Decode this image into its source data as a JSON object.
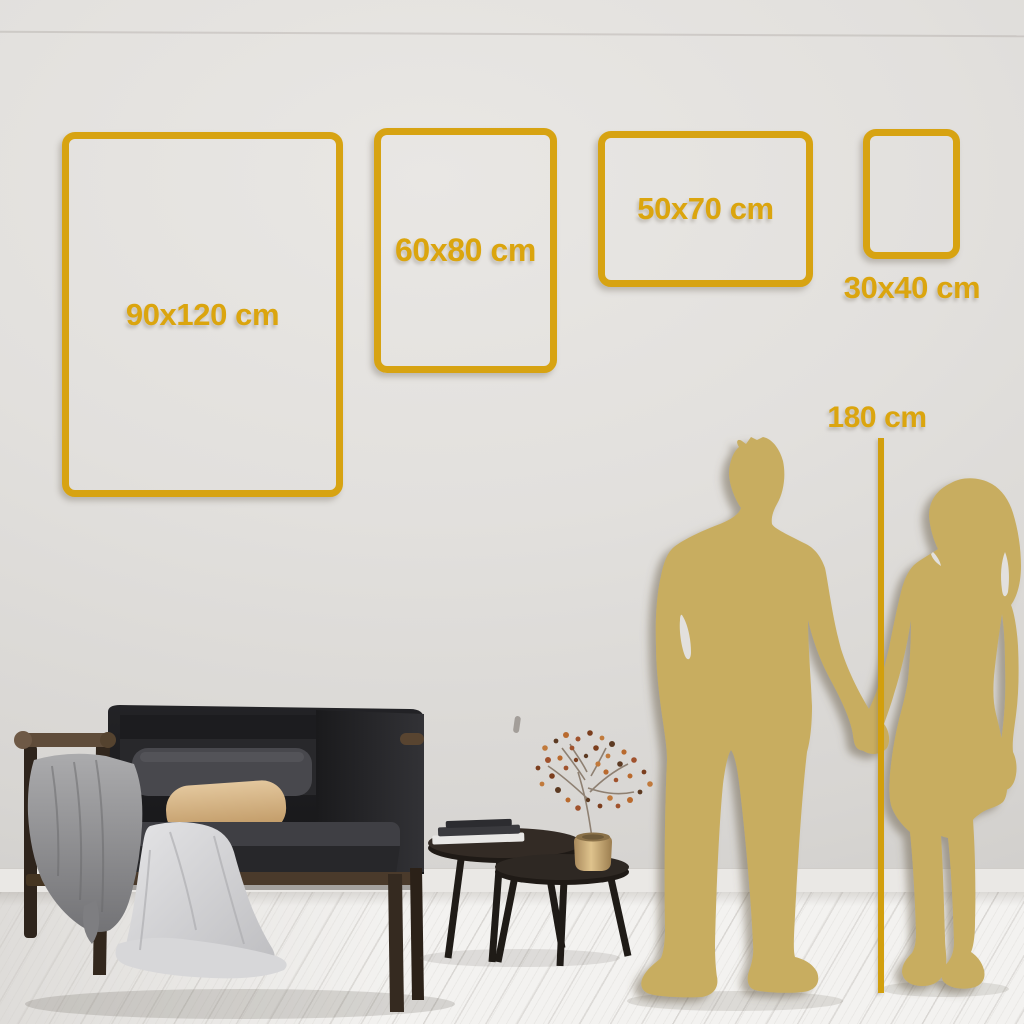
{
  "meta": {
    "description": "Wall-art poster size guide mockup"
  },
  "colors": {
    "gold": "#D7A312",
    "gold-text": "#DBA50E",
    "sil-gold": "#C8AD60",
    "wall": "#DFDDDA",
    "floor": "#F2F1EF"
  },
  "size_frames": [
    {
      "label": "90x120 cm",
      "orientation": "portrait",
      "label_placement": "inside"
    },
    {
      "label": "60x80 cm",
      "orientation": "portrait",
      "label_placement": "inside"
    },
    {
      "label": "50x70 cm",
      "orientation": "landscape",
      "label_placement": "inside"
    },
    {
      "label": "30x40 cm",
      "orientation": "portrait",
      "label_placement": "below"
    }
  ],
  "height_reference": {
    "label": "180 cm"
  },
  "scene": {
    "objects": [
      "dark-loveseat-sofa",
      "gray-blanket",
      "light-throw",
      "beige-pillow",
      "nesting-coffee-tables",
      "books-stack",
      "brass-vase-dried-branch",
      "man-silhouette",
      "woman-silhouette"
    ]
  }
}
